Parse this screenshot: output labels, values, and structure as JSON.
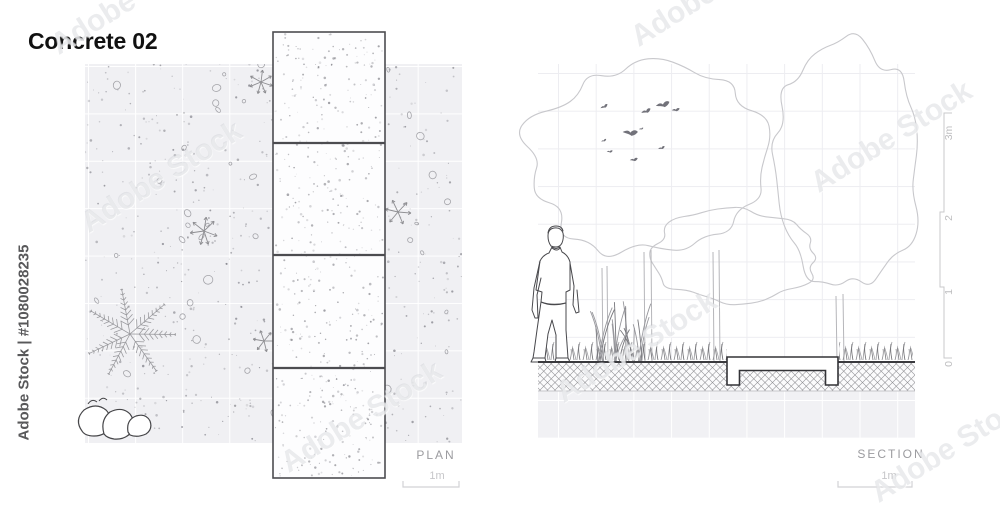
{
  "title": "Concrete 02",
  "watermark": {
    "diagonal_text": "Adobe Stock",
    "side_text": "Adobe Stock | #1080028235"
  },
  "plan": {
    "label": "PLAN",
    "scale_label": "1m"
  },
  "section": {
    "label": "SECTION",
    "scale_label": "1m",
    "vertical_scale": {
      "labels": [
        "3m",
        "2",
        "1",
        "0"
      ]
    }
  },
  "colors": {
    "title": "#111111",
    "label_gray": "#9b9b9f",
    "scale_gray": "#c6c6c9",
    "plan_background": "#f0f0f3",
    "ground_line": "#3a3a3e",
    "bird_gray": "#72727a",
    "watermark_gray": "#58585a"
  }
}
